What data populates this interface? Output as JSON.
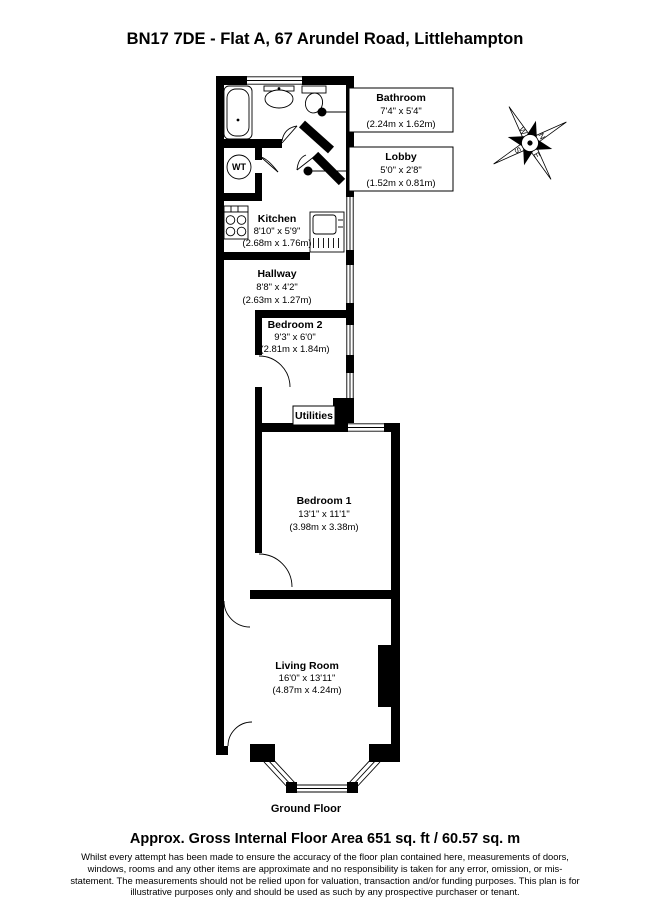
{
  "title": "BN17 7DE - Flat A, 67 Arundel Road, Littlehampton",
  "plan": {
    "floor_label": "Ground Floor",
    "wt_label": "WT",
    "compass": {
      "n": "N",
      "e": "E",
      "s": "S",
      "w": "W"
    },
    "rooms": {
      "bathroom": {
        "name": "Bathroom",
        "size_imperial": "7'4\" x 5'4\"",
        "size_metric": "(2.24m x 1.62m)"
      },
      "lobby": {
        "name": "Lobby",
        "size_imperial": "5'0\" x 2'8\"",
        "size_metric": "(1.52m x 0.81m)"
      },
      "kitchen": {
        "name": "Kitchen",
        "size_imperial": "8'10\" x 5'9\"",
        "size_metric": "(2.68m x 1.76m)"
      },
      "hallway": {
        "name": "Hallway",
        "size_imperial": "8'8\" x 4'2\"",
        "size_metric": "(2.63m x 1.27m)"
      },
      "bedroom2": {
        "name": "Bedroom 2",
        "size_imperial": "9'3\" x 6'0\"",
        "size_metric": "(2.81m x 1.84m)"
      },
      "utilities": {
        "name": "Utilities"
      },
      "bedroom1": {
        "name": "Bedroom 1",
        "size_imperial": "13'1\" x 11'1\"",
        "size_metric": "(3.98m x 3.38m)"
      },
      "living_room": {
        "name": "Living Room",
        "size_imperial": "16'0\" x 13'11\"",
        "size_metric": "(4.87m x 4.24m)"
      }
    }
  },
  "footer": {
    "area_line": "Approx. Gross Internal Floor Area 651 sq. ft / 60.57 sq. m",
    "disclaimer": "Whilst every attempt has been made to ensure the accuracy of the floor plan contained here, measurements of doors, windows, rooms and any other items are approximate and no responsibility is taken for any error, omission, or mis-statement. The measurements should not be relied upon for valuation, transaction and/or funding purposes. This plan is for illustrative purposes only and should be used as such by any prospective purchaser or tenant."
  },
  "colors": {
    "wall": "#000000",
    "background": "#ffffff"
  }
}
